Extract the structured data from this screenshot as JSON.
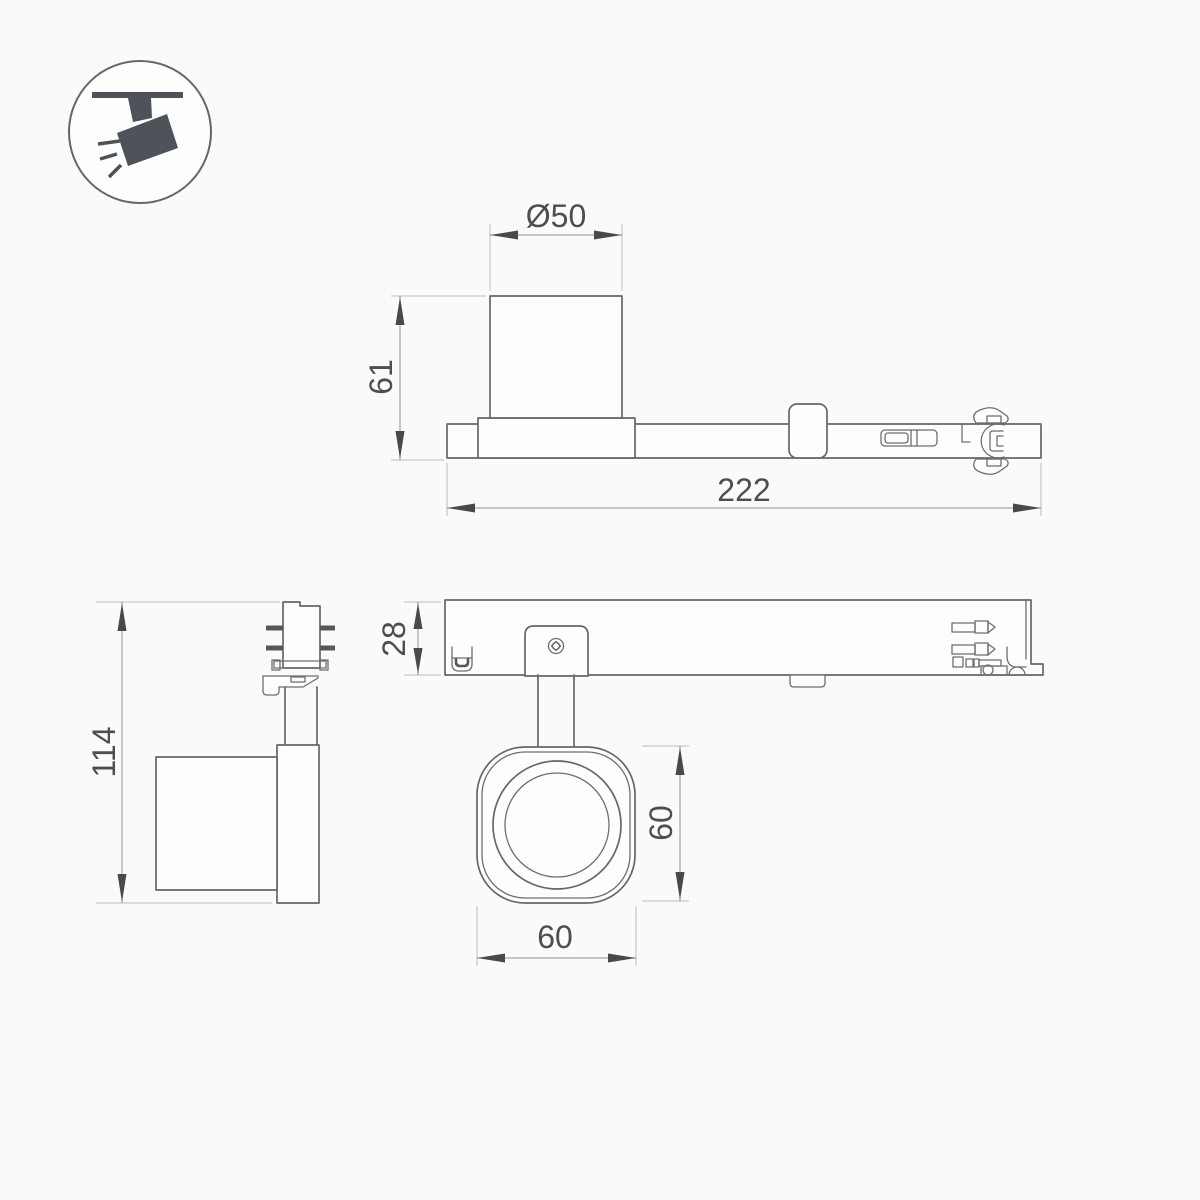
{
  "page": {
    "title": "Track spotlight dimensional drawing",
    "background": "#fafafa",
    "width": 1200,
    "height": 1200
  },
  "icon": {
    "name": "track-spotlight",
    "meaning": "ceiling track-mounted spotlight pictogram"
  },
  "drawing": {
    "side_view": {
      "diameter_label": "Ø50",
      "height_label": "61",
      "length_label": "222"
    },
    "front_view": {
      "height_label": "114"
    },
    "top_view": {
      "depth_label": "28",
      "head_height_label": "60",
      "head_width_label": "60"
    }
  },
  "colors": {
    "object_line": "#64676b",
    "dimension_line": "#8f9294",
    "extension_line": "#babdbf",
    "dimension_text": "#4c4e50",
    "icon_fill": "#4d5358",
    "background": "#fafafa"
  }
}
